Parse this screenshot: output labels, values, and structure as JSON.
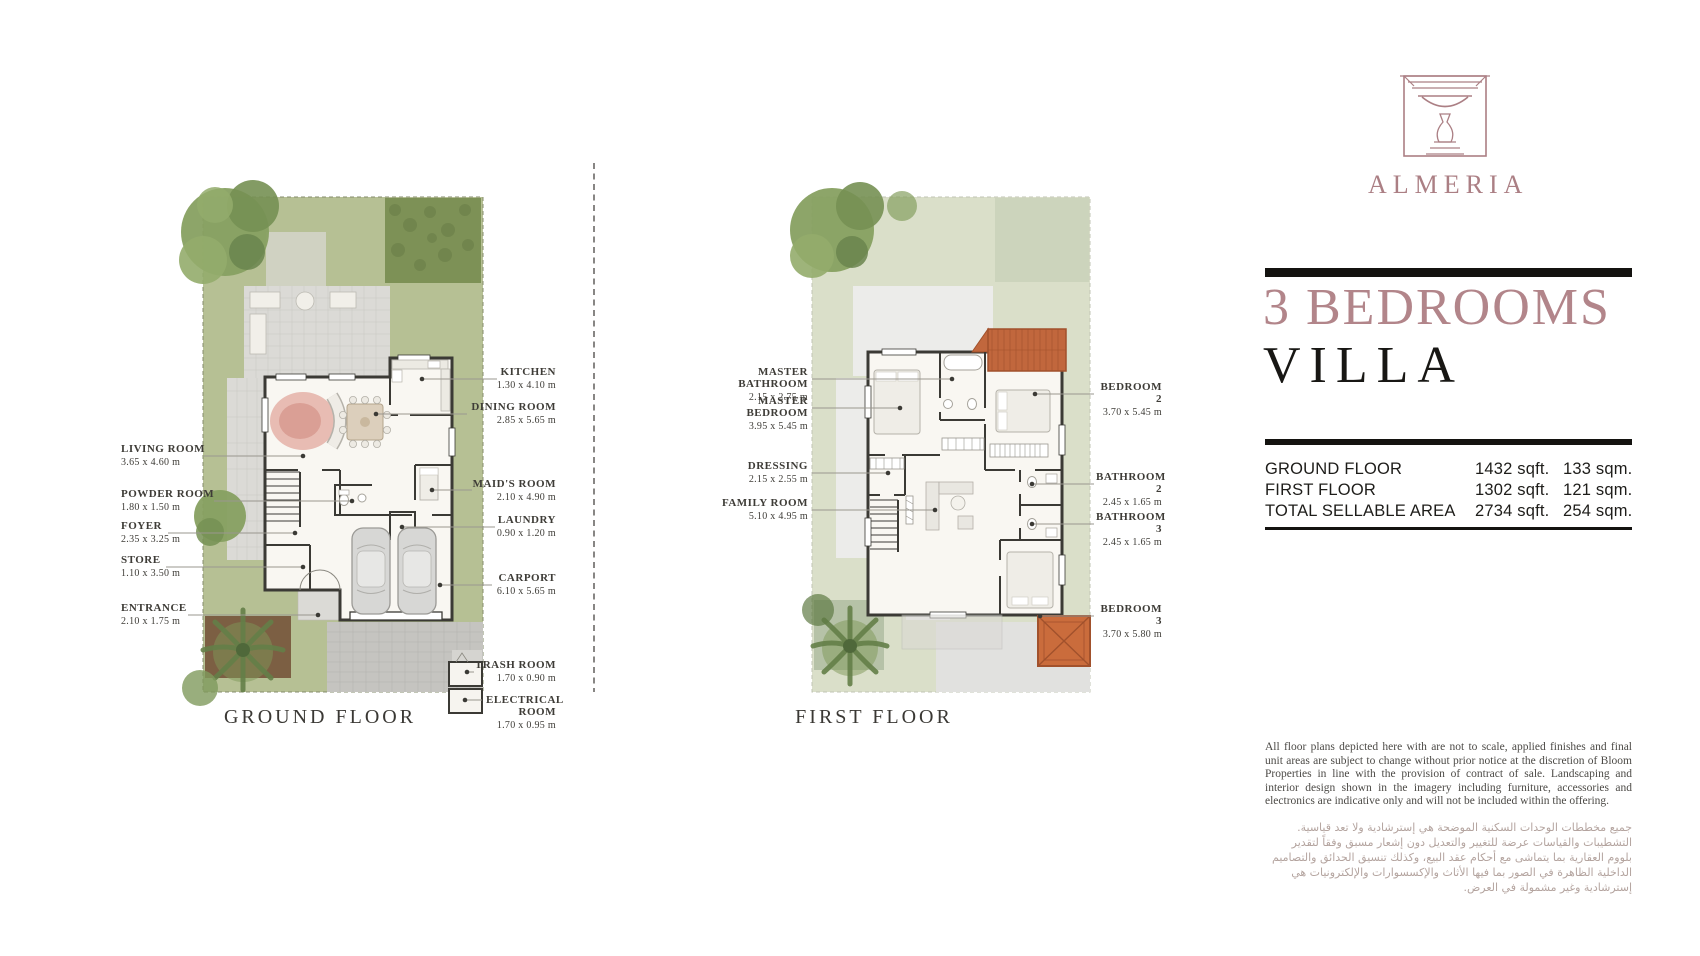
{
  "brand": {
    "name": "ALMERIA",
    "logo_icon": "fountain-icon",
    "accent_color": "#b2858a",
    "rose_color": "#ab7f84",
    "ink_color": "#181714"
  },
  "heading": {
    "line1": "3 BEDROOMS",
    "line2": "VILLA"
  },
  "area_table": {
    "rows": [
      {
        "label": "GROUND FLOOR",
        "sqft": "1432 sqft.",
        "sqm": "133 sqm."
      },
      {
        "label": "FIRST FLOOR",
        "sqft": "1302 sqft.",
        "sqm": "121 sqm."
      },
      {
        "label": "TOTAL SELLABLE AREA",
        "sqft": "2734 sqft.",
        "sqm": "254 sqm."
      }
    ]
  },
  "ground_floor": {
    "caption": "GROUND FLOOR",
    "labels_left": [
      {
        "name": "LIVING ROOM",
        "dims": "3.65 x 4.60 m"
      },
      {
        "name": "POWDER ROOM",
        "dims": "1.80 x 1.50 m"
      },
      {
        "name": "FOYER",
        "dims": "2.35 x 3.25 m"
      },
      {
        "name": "STORE",
        "dims": "1.10 x 3.50 m"
      },
      {
        "name": "ENTRANCE",
        "dims": "2.10 x 1.75 m"
      }
    ],
    "labels_right": [
      {
        "name": "KITCHEN",
        "dims": "1.30 x 4.10 m"
      },
      {
        "name": "DINING ROOM",
        "dims": "2.85 x 5.65 m"
      },
      {
        "name": "MAID'S ROOM",
        "dims": "2.10 x 4.90 m"
      },
      {
        "name": "LAUNDRY",
        "dims": "0.90 x 1.20 m"
      },
      {
        "name": "CARPORT",
        "dims": "6.10 x 5.65 m"
      },
      {
        "name": "TRASH ROOM",
        "dims": "1.70 x 0.90 m"
      },
      {
        "name": "ELECTRICAL ROOM",
        "dims": "1.70 x 0.95 m"
      }
    ]
  },
  "first_floor": {
    "caption": "FIRST FLOOR",
    "labels_left": [
      {
        "name": "MASTER BATHROOM",
        "dims": "2.15 x 2.75 m"
      },
      {
        "name": "MASTER BEDROOM",
        "dims": "3.95 x 5.45 m"
      },
      {
        "name": "DRESSING",
        "dims": "2.15 x 2.55 m"
      },
      {
        "name": "FAMILY ROOM",
        "dims": "5.10 x 4.95 m"
      }
    ],
    "labels_right": [
      {
        "name": "BEDROOM 2",
        "dims": "3.70 x 5.45 m"
      },
      {
        "name": "BATHROOM 2",
        "dims": "2.45 x 1.65 m"
      },
      {
        "name": "BATHROOM 3",
        "dims": "2.45 x 1.65 m"
      },
      {
        "name": "BEDROOM 3",
        "dims": "3.70 x 5.80 m"
      }
    ]
  },
  "disclaimer": {
    "en": "All floor plans depicted here with are not to scale, applied finishes and final unit areas are subject to change without prior notice at the discretion of Bloom Properties in line with the provision of contract of sale. Landscaping and interior design shown in the imagery including furniture, accessories and electronics are indicative only and will not be included within the offering.",
    "ar": "جميع مخططات الوحدات السكنية الموضحة هي إسترشادية ولا تعد قياسية. التشطيبات والقياسات عرضة للتغيير والتعديل دون إشعار مسبق وفقاً لتقدير بلووم العقارية بما يتماشى مع أحكام عقد البيع، وكذلك تنسيق الحدائق والتصاميم الداخلية الظاهرة في الصور بما فيها الأثاث والإكسسوارات والإلكترونيات هي إسترشادية وغير مشمولة في العرض."
  }
}
